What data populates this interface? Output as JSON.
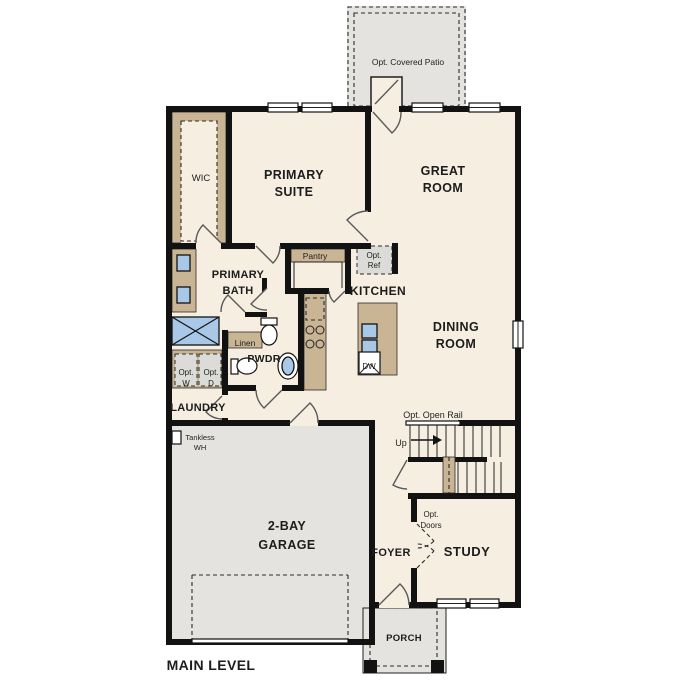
{
  "plan": {
    "labels": {
      "opt_covered_patio": [
        "Opt. Covered Patio"
      ],
      "wic": [
        "WIC"
      ],
      "primary_suite": [
        "PRIMARY",
        "SUITE"
      ],
      "great_room": [
        "GREAT",
        "ROOM"
      ],
      "primary_bath": [
        "PRIMARY",
        "BATH"
      ],
      "pantry": [
        "Pantry"
      ],
      "opt_ref": [
        "Opt.",
        "Ref"
      ],
      "kitchen": [
        "KITCHEN"
      ],
      "dining_room": [
        "DINING",
        "ROOM"
      ],
      "linen": [
        "Linen"
      ],
      "pwdr": [
        "PWDR"
      ],
      "opt_w": [
        "Opt.",
        "W"
      ],
      "opt_d": [
        "Opt.",
        "D"
      ],
      "laundry": [
        "LAUNDRY"
      ],
      "dw": [
        "DW"
      ],
      "opt_open_rail": [
        "Opt. Open Rail"
      ],
      "up": [
        "Up"
      ],
      "tankless_wh": [
        "Tankless",
        "WH"
      ],
      "opt_doors": [
        "Opt.",
        "Doors"
      ],
      "foyer": [
        "FOYER"
      ],
      "study": [
        "STUDY"
      ],
      "garage": [
        "2-BAY",
        "GARAGE"
      ],
      "porch": [
        "PORCH"
      ],
      "main_level": [
        "MAIN LEVEL"
      ]
    },
    "colors": {
      "floor": "#f6eee1",
      "outdoor_area": "#e4e3df",
      "counter": "#c9b493",
      "plumbing_fixture": "#a9c8e8",
      "optional_appliance": "#dbdbd7",
      "wall": "#121212"
    }
  }
}
